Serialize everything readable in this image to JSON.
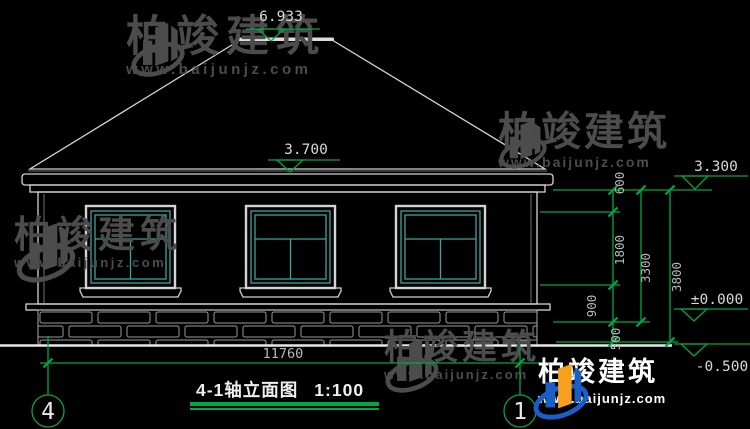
{
  "title": {
    "text": "4-1轴立面图",
    "scale": "1:100"
  },
  "watermark": {
    "brand": "柏竣建筑",
    "url": "www.baijunjz.com"
  },
  "axes": {
    "left": "4",
    "right": "1"
  },
  "dimensions": {
    "total_width": "11760",
    "right_chain": {
      "seg1": "600",
      "seg2": "1800",
      "seg3": "900",
      "seg4": "500",
      "subtotal": "3300",
      "total": "3800"
    }
  },
  "elevations": {
    "ridge": "6.933",
    "eave_top": "3.700",
    "eave": "3.300",
    "floor": "±0.000",
    "ground": "-0.500"
  },
  "colors": {
    "background": "#000000",
    "line_white": "#d4d4d4",
    "dimension_green": "#00a843",
    "window_teal": "#3fa3a0",
    "watermark_gray": "#4c4c4c",
    "logo_blue": "#1a5fc8",
    "logo_orange": "#f5a01e"
  }
}
